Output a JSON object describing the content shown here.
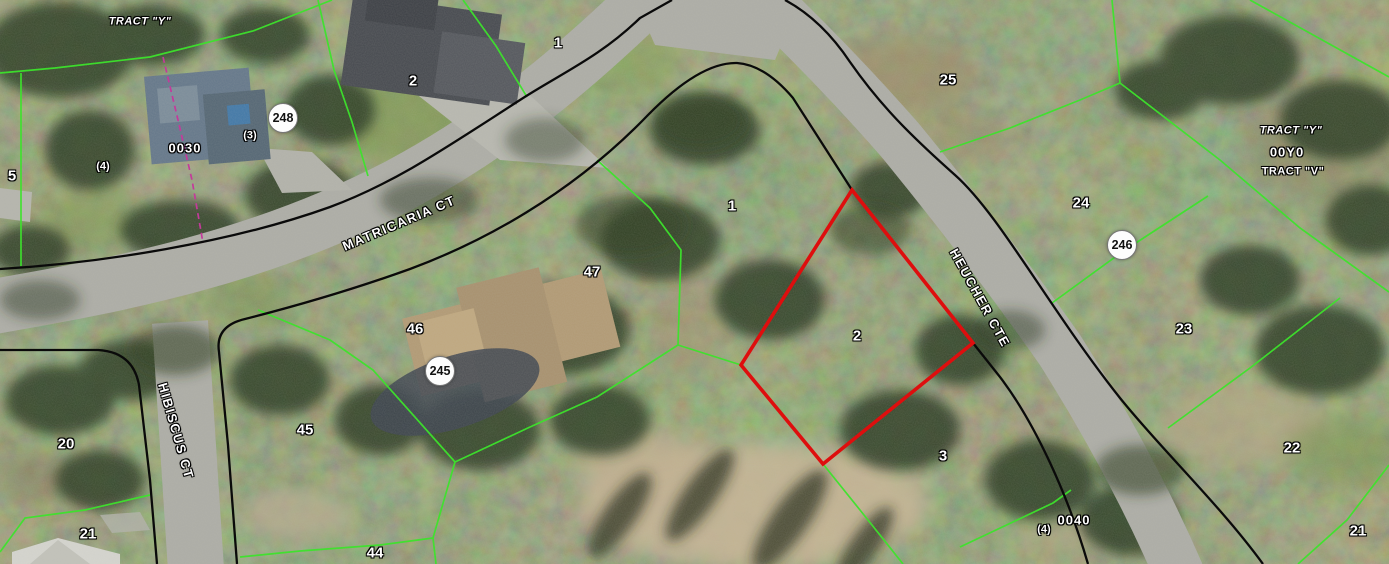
{
  "map": {
    "streets": [
      {
        "name": "MATRICARIA CT",
        "x": 399,
        "y": 223,
        "angle": -23
      },
      {
        "name": "HEUCHER CTE",
        "x": 980,
        "y": 298,
        "angle": 61
      },
      {
        "name": "HIBISCUS CT",
        "x": 176,
        "y": 431,
        "angle": 74
      }
    ],
    "block_markers": [
      {
        "number": "248",
        "x": 283,
        "y": 118
      },
      {
        "number": "245",
        "x": 440,
        "y": 371
      },
      {
        "number": "246",
        "x": 1122,
        "y": 245
      }
    ],
    "lot_numbers": [
      {
        "text": "1",
        "x": 558,
        "y": 43
      },
      {
        "text": "2",
        "x": 413,
        "y": 81
      },
      {
        "text": "25",
        "x": 948,
        "y": 80
      },
      {
        "text": "5",
        "x": 12,
        "y": 176
      },
      {
        "text": "1",
        "x": 732,
        "y": 206
      },
      {
        "text": "24",
        "x": 1081,
        "y": 203
      },
      {
        "text": "47",
        "x": 592,
        "y": 272
      },
      {
        "text": "46",
        "x": 415,
        "y": 329
      },
      {
        "text": "2",
        "x": 857,
        "y": 336
      },
      {
        "text": "23",
        "x": 1184,
        "y": 329
      },
      {
        "text": "45",
        "x": 305,
        "y": 430
      },
      {
        "text": "20",
        "x": 66,
        "y": 444
      },
      {
        "text": "22",
        "x": 1292,
        "y": 448
      },
      {
        "text": "3",
        "x": 943,
        "y": 456
      },
      {
        "text": "21",
        "x": 88,
        "y": 534
      },
      {
        "text": "21",
        "x": 1358,
        "y": 531
      },
      {
        "text": "44",
        "x": 375,
        "y": 553
      }
    ],
    "parcel_ids": [
      {
        "text": "0030",
        "x": 185,
        "y": 148,
        "small": false
      },
      {
        "text": "(4)",
        "x": 103,
        "y": 167,
        "small": true
      },
      {
        "text": "(3)",
        "x": 250,
        "y": 136,
        "small": true
      },
      {
        "text": "00Y0",
        "x": 1287,
        "y": 152,
        "small": false
      },
      {
        "text": "0040",
        "x": 1074,
        "y": 520,
        "small": false
      },
      {
        "text": "(4)",
        "x": 1044,
        "y": 530,
        "small": true
      }
    ],
    "tract_labels": [
      {
        "text": "TRACT \"Y\"",
        "x": 140,
        "y": 22,
        "italic": true
      },
      {
        "text": "TRACT \"Y\"",
        "x": 1291,
        "y": 131,
        "italic": true
      },
      {
        "text": "TRACT \"V\"",
        "x": 1293,
        "y": 172,
        "italic": false
      }
    ],
    "selected_parcel": {
      "lot": "2"
    },
    "colors": {
      "parcel_line": "#3de32c",
      "boundary_line": "#0a0a0a",
      "selected_outline": "#de0e0e",
      "survey_line": "#c43a9b",
      "road_surface": "#adada6",
      "label_text": "#ffffff",
      "label_halo": "#000000"
    }
  }
}
